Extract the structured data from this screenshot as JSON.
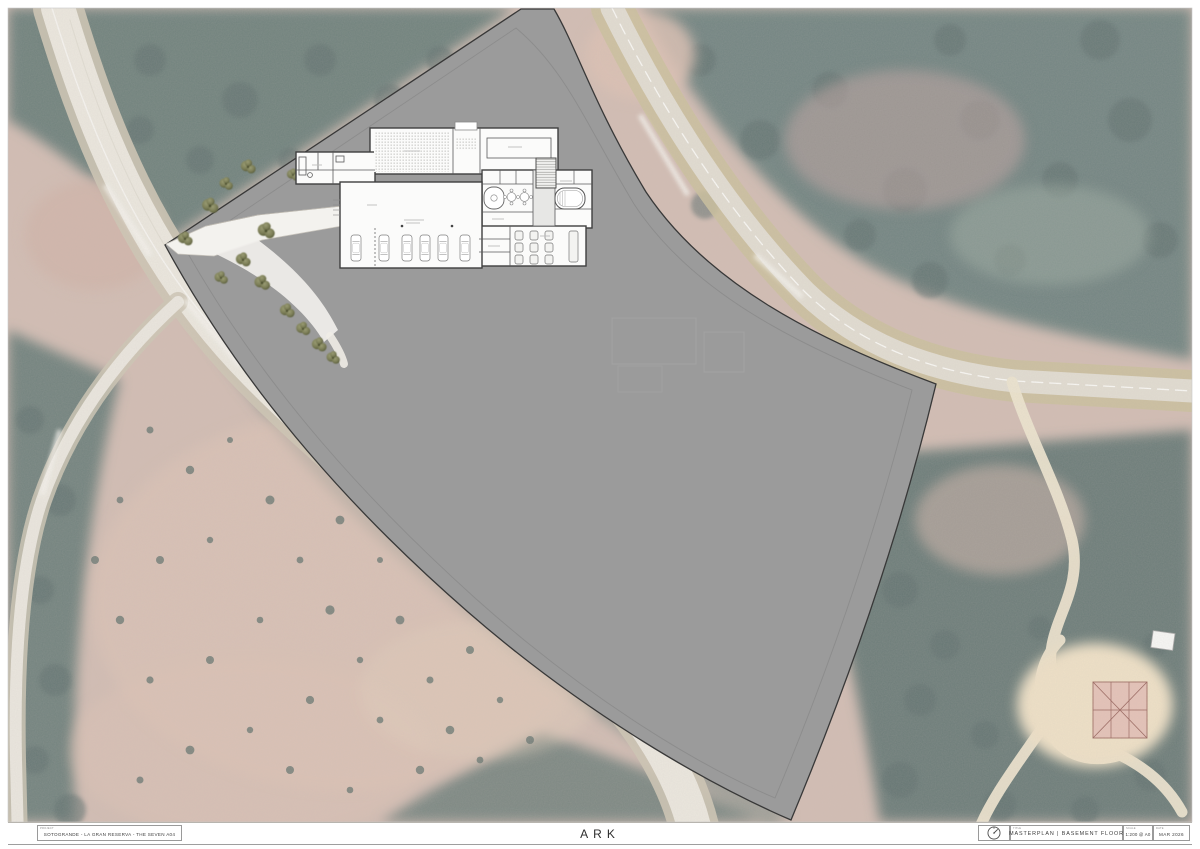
{
  "sheet": {
    "project": "SOTOGRANDE - LA GRAN RESERVA - THE SEVEN A04",
    "project_label": "PROJECT",
    "logo": "ARK",
    "drawing_title": "MASTERPLAN | BASEMENT FLOOR",
    "drawing_title_label": "TITLE",
    "scale": "1:200 @ A0",
    "scale_label": "SCALE",
    "date": "MAR 2026",
    "date_label": "DATE"
  },
  "colors": {
    "paper": "#ffffff",
    "site_overlay_gray": "#9b9b9b",
    "site_boundary": "#383838",
    "road_surface": "#e8e4da",
    "sandy_verge": "#c3b78e",
    "forest_teal": "#5e7370",
    "terrain_pink": "#cbb3a8",
    "plan_wall": "#3f3f3f",
    "plan_room": "#fbfbfa",
    "landscape_tree_olive": "#7c7e57",
    "red_structure": "#dfb3ab"
  },
  "icons": {
    "north_arrow": "compass circle with needle"
  }
}
